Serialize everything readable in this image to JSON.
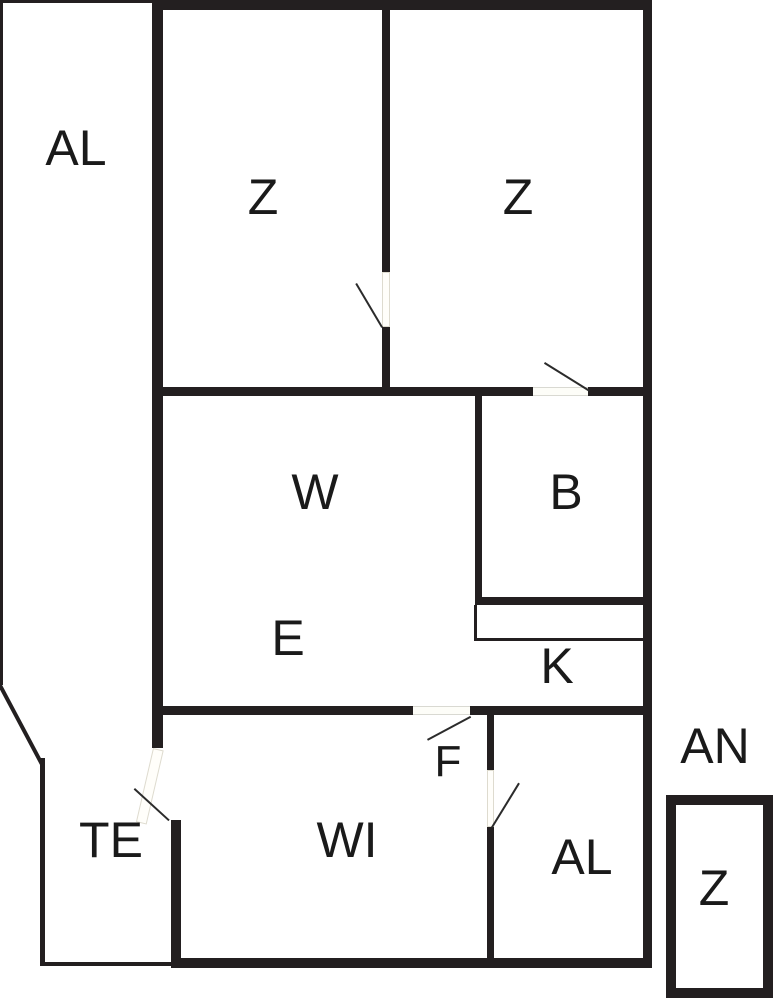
{
  "diagram_type": "floor-plan",
  "colors": {
    "wall": "#231f20",
    "background": "#ffffff",
    "door_swing": "#2b2b2b",
    "label_text": "#1a1a1a"
  },
  "rooms": {
    "al_top": "AL",
    "z_left": "Z",
    "z_right": "Z",
    "w": "W",
    "b": "B",
    "e": "E",
    "k": "K",
    "f": "F",
    "te": "TE",
    "wi": "WI",
    "al_bottom": "AL",
    "an": "AN",
    "z_annex": "Z"
  }
}
